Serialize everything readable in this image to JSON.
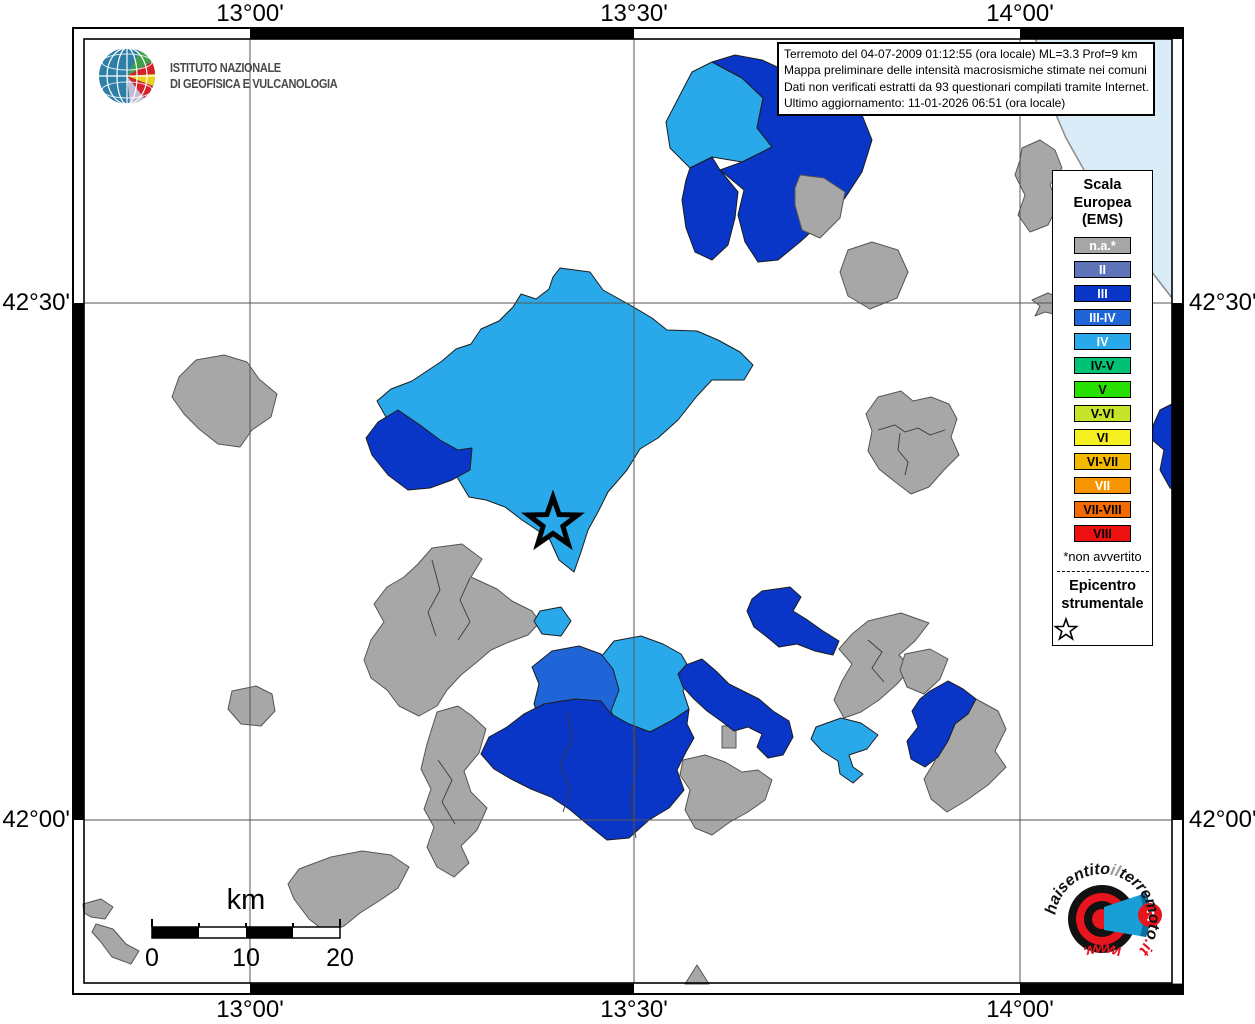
{
  "info_box": {
    "lines": [
      "Terremoto del 04-07-2009 01:12:55 (ora locale) ML=3.3 Prof=9 km",
      "Mappa preliminare delle intensità macrosismiche stimate nei comuni",
      "Dati non verificati estratti da 93 questionari compilati tramite Internet.",
      "Ultimo aggiornamento: 11-01-2026 06:51 (ora locale)"
    ]
  },
  "ingv": {
    "line1": "ISTITUTO NAZIONALE",
    "line2": "DI GEOFISICA E VULCANOLOGIA"
  },
  "axes": {
    "top": [
      "13°00'",
      "13°30'",
      "14°00'"
    ],
    "bottom": [
      "13°00'",
      "13°30'",
      "14°00'"
    ],
    "left": [
      "42°30'",
      "42°00'"
    ],
    "right": [
      "42°30'",
      "42°00'"
    ]
  },
  "legend": {
    "title_lines": [
      "Scala",
      "Europea",
      "(EMS)"
    ],
    "items": [
      {
        "label": "n.a.*",
        "color": "#a7a7a7",
        "text_color": "#ffffff"
      },
      {
        "label": "II",
        "color": "#5d74b9",
        "text_color": "#ffffff"
      },
      {
        "label": "III",
        "color": "#0a36c8",
        "text_color": "#ffffff"
      },
      {
        "label": "III-IV",
        "color": "#1f65d8",
        "text_color": "#ffffff"
      },
      {
        "label": "IV",
        "color": "#29a9e9",
        "text_color": "#ffffff"
      },
      {
        "label": "IV-V",
        "color": "#00c274",
        "text_color": "#000000"
      },
      {
        "label": "V",
        "color": "#27e000",
        "text_color": "#000000"
      },
      {
        "label": "V-VI",
        "color": "#c6e52a",
        "text_color": "#000000"
      },
      {
        "label": "VI",
        "color": "#f7f021",
        "text_color": "#000000"
      },
      {
        "label": "VI-VII",
        "color": "#f3b800",
        "text_color": "#000000"
      },
      {
        "label": "VII",
        "color": "#f79500",
        "text_color": "#ffffff"
      },
      {
        "label": "VII-VIII",
        "color": "#f26a00",
        "text_color": "#000000"
      },
      {
        "label": "VIII",
        "color": "#ee1111",
        "text_color": "#000000"
      }
    ],
    "footnote": "*non avvertito",
    "epicenter_lines": [
      "Epicentro",
      "strumentale"
    ]
  },
  "scale_bar": {
    "unit": "km",
    "labels": [
      "0",
      "10",
      "20"
    ]
  },
  "watermark": {
    "top_parts": [
      {
        "t": "haisentito",
        "c": "#111111"
      },
      {
        "t": "il",
        "c": "#9a9a9a"
      },
      {
        "t": "terremoto",
        "c": "#111111"
      },
      {
        "t": ".it",
        "c": "#e8141e"
      }
    ],
    "bottom_parts": [
      {
        "t": "www.",
        "c": "#e8141e"
      }
    ],
    "question_mark": "?"
  },
  "map": {
    "background": "#ffffff",
    "sea": {
      "color": "#d9ecf7",
      "points": "1035,39 1047,60 1060,84 1054,110 1066,138 1084,170 1107,204 1129,238 1151,271 1172,298 1172,39",
      "coast": "1035,39 1047,60 1060,84 1054,110 1066,138 1084,170 1107,204 1129,238 1151,271 1172,298"
    },
    "class_colors": {
      "na": "#a7a7a7",
      "III": "#0a36c8",
      "III-IV": "#1f65d8",
      "IV": "#29a9e9"
    },
    "gridlines": {
      "vertical_x": [
        250,
        634,
        1020
      ],
      "horizontal_y": [
        303,
        820
      ]
    },
    "epicenter": {
      "x": 553,
      "y": 523
    },
    "polygons": [
      {
        "class": "na",
        "points": "1022,148 1040,140 1055,150 1062,168 1050,185 1058,205 1048,225 1030,232 1018,215 1025,195 1015,175 1020,160"
      },
      {
        "class": "na",
        "points": "1032,300 1048,293 1060,298 1052,306 1062,316 1045,312 1035,316 1040,306"
      },
      {
        "class": "IV",
        "points": "712,62 742,78 763,98 757,128 772,147 742,162 712,157 690,168 670,148 666,122 681,93 692,72"
      },
      {
        "class": "III",
        "points": "757,128 763,98 742,78 712,62 735,55 762,60 788,72 812,80 838,92 860,110 872,140 862,172 845,198 822,222 800,242 778,260 758,262 745,242 738,215 744,190 720,170 742,162 772,147"
      },
      {
        "class": "III",
        "points": "690,168 712,157 720,170 738,192 735,218 728,245 712,260 695,252 686,228 682,200 686,180"
      },
      {
        "class": "na",
        "points": "800,175 824,178 845,192 840,218 820,238 802,230 795,205 795,188"
      },
      {
        "class": "na",
        "points": "848,250 872,242 898,250 908,272 897,298 870,309 848,296 840,272"
      },
      {
        "class": "IV",
        "points": "560,268 590,272 603,290 630,305 652,318 667,330 697,331 718,340 740,352 753,365 744,380 712,380 697,396 678,420 658,438 640,449 627,470 608,492 598,512 588,530 581,552 574,572 559,560 549,538 522,520 505,507 486,500 469,497 457,477 447,459 430,452 410,444 398,430 386,417 377,401 391,389 412,381 427,371 442,361 456,349 471,344 481,329 499,321 513,307 521,294 536,299 549,289 553,277"
      },
      {
        "class": "III",
        "points": "398,410 420,425 440,440 458,450 472,448 470,470 452,480 430,488 408,490 388,475 372,455 366,438 378,422"
      },
      {
        "class": "na",
        "points": "196,360 224,355 247,362 259,379 277,394 271,417 252,430 240,447 218,444 199,429 184,414 172,397 179,377"
      },
      {
        "class": "na",
        "points": "878,397 901,391 913,401 931,397 949,404 957,419 951,437 959,455 944,470 929,487 911,494 894,481 879,469 868,451 872,431 866,414"
      },
      {
        "class": "III",
        "points": "1152,428 1160,410 1172,404 1183,410 1183,492 1170,488 1160,470 1164,450 1150,438"
      },
      {
        "class": "na",
        "points": "432,548 462,544 482,559 471,577 497,589 512,601 532,611 540,622 528,635 509,642 491,650 477,662 461,675 447,690 437,706 419,716 399,706 387,690 371,678 364,660 371,640 384,622 374,604 387,587 404,577 418,564"
      },
      {
        "class": "na",
        "points": "437,712 458,706 472,716 486,729 479,753 464,771 471,792 487,808 477,830 461,846 469,863 454,877 437,867 427,847 434,827 424,809 431,789 421,769 427,744"
      },
      {
        "class": "na",
        "points": "232,691 256,686 272,694 275,711 261,726 241,724 228,709"
      },
      {
        "class": "na",
        "points": "299,869 331,857 362,851 391,855 409,867 398,888 379,901 360,913 344,926 327,933 309,919 294,899 288,884"
      },
      {
        "class": "na",
        "points": "83,904 101,899 113,907 105,919 91,917 84,913"
      },
      {
        "class": "na",
        "points": "96,924 113,929 126,944 139,951 131,964 112,957 100,941 92,932"
      },
      {
        "class": "na",
        "points": "685,984 697,965 709,984"
      },
      {
        "class": "na",
        "points": "683,760 705,755 725,762 742,772 758,770 772,780 765,800 748,812 730,822 712,835 695,828 685,810 690,790 680,775"
      },
      {
        "class": "na",
        "points": "868,621 901,613 929,623 915,641 899,655 911,668 897,684 879,700 861,712 844,718 834,700 842,681 852,664 839,649 852,634"
      },
      {
        "class": "na",
        "points": "905,654 930,649 948,659 940,679 924,694 907,687 900,670"
      },
      {
        "class": "na",
        "points": "934,704 955,694 976,699 998,711 1006,729 995,751 1006,767 988,785 967,800 947,812 931,799 924,779 935,761 921,744 929,724"
      },
      {
        "class": "na",
        "points": "722,726 736,726 736,748 722,748"
      },
      {
        "class": "IV",
        "points": "540,611 561,607 571,621 561,636 542,634 534,621"
      },
      {
        "class": "IV",
        "points": "614,641 641,636 663,644 681,654 691,671 683,691 689,709 671,721 650,732 629,724 611,714 604,694 611,671 601,657"
      },
      {
        "class": "III-IV",
        "points": "552,651 579,646 601,654 613,669 619,690 611,711 619,729 601,741 578,748 557,739 541,724 534,704 539,684 532,667"
      },
      {
        "class": "III",
        "points": "544,704 575,699 601,701 611,714 629,724 650,732 671,721 689,709 687,724 694,738 686,752 677,770 684,790 669,808 649,820 629,838 607,840 587,824 569,809 551,797 531,789 511,779 494,769 481,754 489,737 507,727 524,714"
      },
      {
        "class": "III",
        "points": "686,665 702,659 716,671 729,684 743,691 759,699 773,711 789,721 793,737 783,755 768,758 757,747 762,734 748,727 734,731 721,721 707,711 694,699 683,687 678,674"
      },
      {
        "class": "III",
        "points": "762,591 790,587 801,597 793,611 806,619 823,631 839,641 833,655 815,651 797,644 779,647 767,637 754,627 747,611 752,599"
      },
      {
        "class": "III",
        "points": "930,691 948,681 963,689 976,699 968,714 955,724 948,741 938,757 925,767 911,759 907,741 918,727 912,711 920,699"
      },
      {
        "class": "IV",
        "points": "816,727 841,718 861,723 878,735 867,749 849,755 853,767 863,774 853,783 840,774 838,761 822,751 811,739"
      }
    ],
    "inner_borders": [
      "878,430 895,425 905,432 918,428 930,435 945,430",
      "900,433 898,450 908,462 905,475",
      "470,578 460,600 470,622 458,640",
      "432,560 440,590 428,612 436,636",
      "567,712 572,740 560,764 570,790 563,812",
      "634,724 638,760 630,800 636,838",
      "868,640 882,652 872,668 884,682",
      "438,760 452,780 442,802 455,824"
    ]
  }
}
